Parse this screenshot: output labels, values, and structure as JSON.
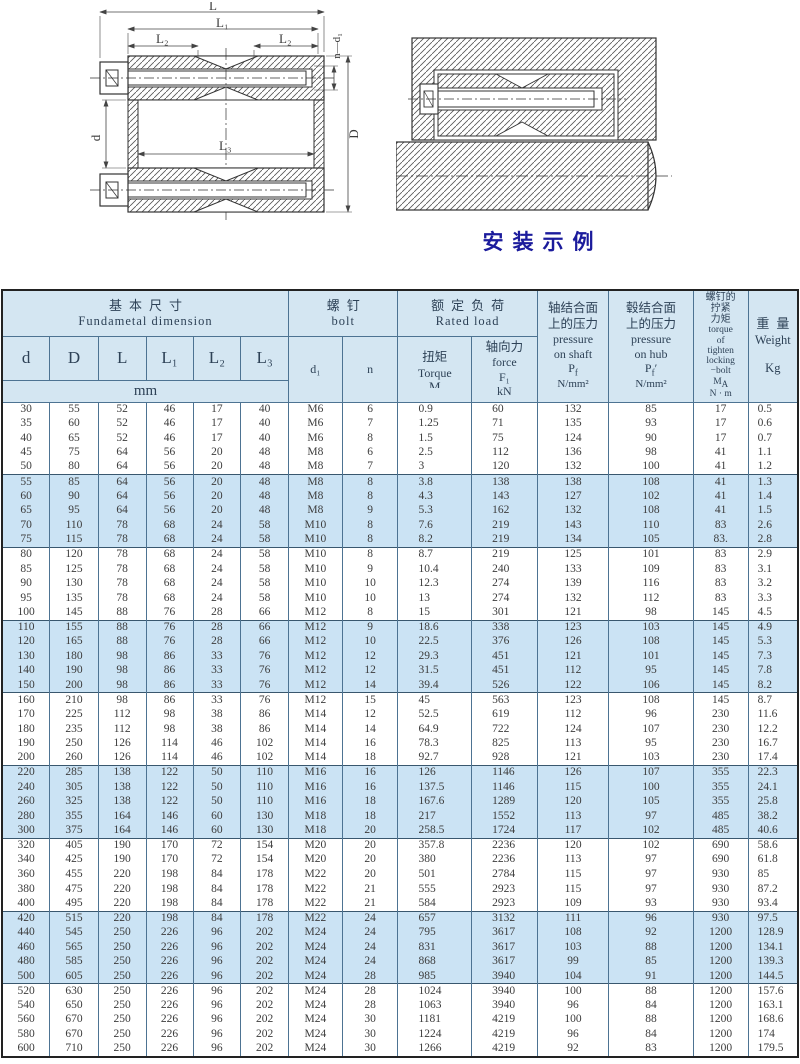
{
  "colors": {
    "band_blue": "#cbe3f4",
    "header_bg": "#d4e6f2",
    "table_border": "#4d7392",
    "caption_blue": "#1b1b9c"
  },
  "diagrams": {
    "caption": "安装示例",
    "left": {
      "dim_L": "L",
      "dim_L1": "L₁",
      "dim_L2_left": "L₂",
      "dim_L2_right": "L₂",
      "dim_L3": "L₃",
      "dim_d": "d",
      "dim_D": "D",
      "dim_nd1": "n—d₁"
    }
  },
  "table": {
    "header": {
      "basic": {
        "zh": "基本尺寸",
        "en": "Fundametal  dimension",
        "unit": "mm",
        "cols": [
          "d",
          "D",
          "L",
          "L₁",
          "L₂",
          "L₃"
        ]
      },
      "bolt": {
        "zh": "螺钉",
        "en": "bolt",
        "d1": "d₁",
        "n": "n"
      },
      "rated": {
        "zh": "额定负荷",
        "en": "Rated load",
        "torque_zh": "扭矩",
        "torque_en": "Torque",
        "torque_sym": "M",
        "force_zh": "轴向力",
        "force_en": "force",
        "force_sym": "F₁",
        "force_unit": "kN"
      },
      "pshaft": {
        "zh1": "轴结合面",
        "zh2": "上的压力",
        "en1": "pressure",
        "en2": "on shaft",
        "sym": "P",
        "sub": "f",
        "unit": "N/mm²"
      },
      "phub": {
        "zh1": "毂结合面",
        "zh2": "上的压力",
        "en1": "pressure",
        "en2": "on hub",
        "sym": "P",
        "sub": "f",
        "prime": "′",
        "unit": "N/mm²"
      },
      "ma": {
        "zh1": "螺钉的",
        "zh2": "拧紧",
        "zh3": "力矩",
        "en1": "torque",
        "en2": "of",
        "en3": "tighten",
        "en4": "locking",
        "en5": "−bolt",
        "sym": "M",
        "sub": "A",
        "unit": "N · m"
      },
      "weight": {
        "zh": "重量",
        "en": "Weight",
        "unit": "Kg"
      }
    },
    "rows": [
      [
        "30",
        "55",
        "52",
        "46",
        "17",
        "40",
        "M6",
        "6",
        "0.9",
        "60",
        "132",
        "85",
        "17",
        "0.5"
      ],
      [
        "35",
        "60",
        "52",
        "46",
        "17",
        "40",
        "M6",
        "7",
        "1.25",
        "71",
        "135",
        "93",
        "17",
        "0.6"
      ],
      [
        "40",
        "65",
        "52",
        "46",
        "17",
        "40",
        "M6",
        "8",
        "1.5",
        "75",
        "124",
        "90",
        "17",
        "0.7"
      ],
      [
        "45",
        "75",
        "64",
        "56",
        "20",
        "48",
        "M8",
        "6",
        "2.5",
        "112",
        "136",
        "98",
        "41",
        "1.1"
      ],
      [
        "50",
        "80",
        "64",
        "56",
        "20",
        "48",
        "M8",
        "7",
        "3",
        "120",
        "132",
        "100",
        "41",
        "1.2"
      ],
      [
        "55",
        "85",
        "64",
        "56",
        "20",
        "48",
        "M8",
        "8",
        "3.8",
        "138",
        "138",
        "108",
        "41",
        "1.3"
      ],
      [
        "60",
        "90",
        "64",
        "56",
        "20",
        "48",
        "M8",
        "8",
        "4.3",
        "143",
        "127",
        "102",
        "41",
        "1.4"
      ],
      [
        "65",
        "95",
        "64",
        "56",
        "20",
        "48",
        "M8",
        "9",
        "5.3",
        "162",
        "132",
        "108",
        "41",
        "1.5"
      ],
      [
        "70",
        "110",
        "78",
        "68",
        "24",
        "58",
        "M10",
        "8",
        "7.6",
        "219",
        "143",
        "110",
        "83",
        "2.6"
      ],
      [
        "75",
        "115",
        "78",
        "68",
        "24",
        "58",
        "M10",
        "8",
        "8.2",
        "219",
        "134",
        "105",
        "83.",
        "2.8"
      ],
      [
        "80",
        "120",
        "78",
        "68",
        "24",
        "58",
        "M10",
        "8",
        "8.7",
        "219",
        "125",
        "101",
        "83",
        "2.9"
      ],
      [
        "85",
        "125",
        "78",
        "68",
        "24",
        "58",
        "M10",
        "9",
        "10.4",
        "240",
        "133",
        "109",
        "83",
        "3.1"
      ],
      [
        "90",
        "130",
        "78",
        "68",
        "24",
        "58",
        "M10",
        "10",
        "12.3",
        "274",
        "139",
        "116",
        "83",
        "3.2"
      ],
      [
        "95",
        "135",
        "78",
        "68",
        "24",
        "58",
        "M10",
        "10",
        "13",
        "274",
        "132",
        "112",
        "83",
        "3.3"
      ],
      [
        "100",
        "145",
        "88",
        "76",
        "28",
        "66",
        "M12",
        "8",
        "15",
        "301",
        "121",
        "98",
        "145",
        "4.5"
      ],
      [
        "110",
        "155",
        "88",
        "76",
        "28",
        "66",
        "M12",
        "9",
        "18.6",
        "338",
        "123",
        "103",
        "145",
        "4.9"
      ],
      [
        "120",
        "165",
        "88",
        "76",
        "28",
        "66",
        "M12",
        "10",
        "22.5",
        "376",
        "126",
        "108",
        "145",
        "5.3"
      ],
      [
        "130",
        "180",
        "98",
        "86",
        "33",
        "76",
        "M12",
        "12",
        "29.3",
        "451",
        "121",
        "101",
        "145",
        "7.3"
      ],
      [
        "140",
        "190",
        "98",
        "86",
        "33",
        "76",
        "M12",
        "12",
        "31.5",
        "451",
        "112",
        "95",
        "145",
        "7.8"
      ],
      [
        "150",
        "200",
        "98",
        "86",
        "33",
        "76",
        "M12",
        "14",
        "39.4",
        "526",
        "122",
        "106",
        "145",
        "8.2"
      ],
      [
        "160",
        "210",
        "98",
        "86",
        "33",
        "76",
        "M12",
        "15",
        "45",
        "563",
        "123",
        "108",
        "145",
        "8.7"
      ],
      [
        "170",
        "225",
        "112",
        "98",
        "38",
        "86",
        "M14",
        "12",
        "52.5",
        "619",
        "112",
        "96",
        "230",
        "11.6"
      ],
      [
        "180",
        "235",
        "112",
        "98",
        "38",
        "86",
        "M14",
        "14",
        "64.9",
        "722",
        "124",
        "107",
        "230",
        "12.2"
      ],
      [
        "190",
        "250",
        "126",
        "114",
        "46",
        "102",
        "M14",
        "16",
        "78.3",
        "825",
        "113",
        "95",
        "230",
        "16.7"
      ],
      [
        "200",
        "260",
        "126",
        "114",
        "46",
        "102",
        "M14",
        "18",
        "92.7",
        "928",
        "121",
        "103",
        "230",
        "17.4"
      ],
      [
        "220",
        "285",
        "138",
        "122",
        "50",
        "110",
        "M16",
        "16",
        "126",
        "1146",
        "126",
        "107",
        "355",
        "22.3"
      ],
      [
        "240",
        "305",
        "138",
        "122",
        "50",
        "110",
        "M16",
        "16",
        "137.5",
        "1146",
        "115",
        "100",
        "355",
        "24.1"
      ],
      [
        "260",
        "325",
        "138",
        "122",
        "50",
        "110",
        "M16",
        "18",
        "167.6",
        "1289",
        "120",
        "105",
        "355",
        "25.8"
      ],
      [
        "280",
        "355",
        "164",
        "146",
        "60",
        "130",
        "M18",
        "18",
        "217",
        "1552",
        "113",
        "97",
        "485",
        "38.2"
      ],
      [
        "300",
        "375",
        "164",
        "146",
        "60",
        "130",
        "M18",
        "20",
        "258.5",
        "1724",
        "117",
        "102",
        "485",
        "40.6"
      ],
      [
        "320",
        "405",
        "190",
        "170",
        "72",
        "154",
        "M20",
        "20",
        "357.8",
        "2236",
        "120",
        "102",
        "690",
        "58.6"
      ],
      [
        "340",
        "425",
        "190",
        "170",
        "72",
        "154",
        "M20",
        "20",
        "380",
        "2236",
        "113",
        "97",
        "690",
        "61.8"
      ],
      [
        "360",
        "455",
        "220",
        "198",
        "84",
        "178",
        "M22",
        "20",
        "501",
        "2784",
        "115",
        "97",
        "930",
        "85"
      ],
      [
        "380",
        "475",
        "220",
        "198",
        "84",
        "178",
        "M22",
        "21",
        "555",
        "2923",
        "115",
        "97",
        "930",
        "87.2"
      ],
      [
        "400",
        "495",
        "220",
        "198",
        "84",
        "178",
        "M22",
        "21",
        "584",
        "2923",
        "109",
        "93",
        "930",
        "93.4"
      ],
      [
        "420",
        "515",
        "220",
        "198",
        "84",
        "178",
        "M22",
        "24",
        "657",
        "3132",
        "111",
        "96",
        "930",
        "97.5"
      ],
      [
        "440",
        "545",
        "250",
        "226",
        "96",
        "202",
        "M24",
        "24",
        "795",
        "3617",
        "108",
        "92",
        "1200",
        "128.9"
      ],
      [
        "460",
        "565",
        "250",
        "226",
        "96",
        "202",
        "M24",
        "24",
        "831",
        "3617",
        "103",
        "88",
        "1200",
        "134.1"
      ],
      [
        "480",
        "585",
        "250",
        "226",
        "96",
        "202",
        "M24",
        "24",
        "868",
        "3617",
        "99",
        "85",
        "1200",
        "139.3"
      ],
      [
        "500",
        "605",
        "250",
        "226",
        "96",
        "202",
        "M24",
        "28",
        "985",
        "3940",
        "104",
        "91",
        "1200",
        "144.5"
      ],
      [
        "520",
        "630",
        "250",
        "226",
        "96",
        "202",
        "M24",
        "28",
        "1024",
        "3940",
        "100",
        "88",
        "1200",
        "157.6"
      ],
      [
        "540",
        "650",
        "250",
        "226",
        "96",
        "202",
        "M24",
        "28",
        "1063",
        "3940",
        "96",
        "84",
        "1200",
        "163.1"
      ],
      [
        "560",
        "670",
        "250",
        "226",
        "96",
        "202",
        "M24",
        "30",
        "1181",
        "4219",
        "100",
        "88",
        "1200",
        "168.6"
      ],
      [
        "580",
        "670",
        "250",
        "226",
        "96",
        "202",
        "M24",
        "30",
        "1224",
        "4219",
        "96",
        "84",
        "1200",
        "174"
      ],
      [
        "600",
        "710",
        "250",
        "226",
        "96",
        "202",
        "M24",
        "30",
        "1266",
        "4219",
        "92",
        "83",
        "1200",
        "179.5"
      ]
    ]
  }
}
